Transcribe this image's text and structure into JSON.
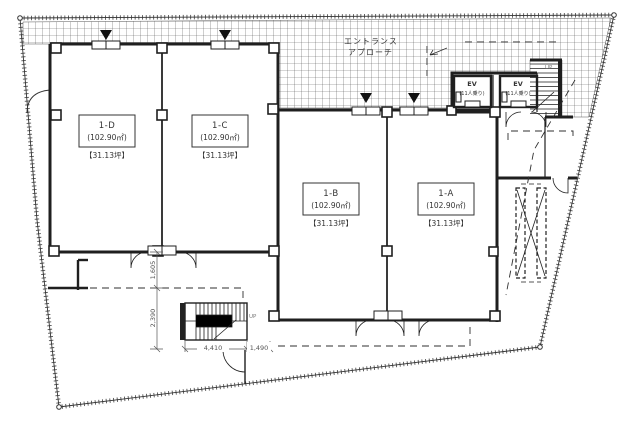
{
  "labels": {
    "entrance_line1": "エントランス",
    "entrance_line2": "アプローチ",
    "up_top": "UP",
    "up_bottom": "UP"
  },
  "units": [
    {
      "name": "1-D",
      "area": "(102.90㎡)",
      "tsubo": "【31.13坪】"
    },
    {
      "name": "1-C",
      "area": "(102.90㎡)",
      "tsubo": "【31.13坪】"
    },
    {
      "name": "1-B",
      "area": "(102.90㎡)",
      "tsubo": "【31.13坪】"
    },
    {
      "name": "1-A",
      "area": "(102.90㎡)",
      "tsubo": "【31.13坪】"
    }
  ],
  "elevators": [
    {
      "label": "EV",
      "capacity": "(11人乗り)"
    },
    {
      "label": "EV",
      "capacity": "(11人乗り)"
    }
  ],
  "dimensions": {
    "width_main": "4,410",
    "width_side": "1,490",
    "depth_upper": "1,605",
    "depth_lower": "2,390"
  },
  "colors": {
    "wall": "#1f1f1f",
    "hatch": "#555555",
    "dim_text": "#555555"
  }
}
